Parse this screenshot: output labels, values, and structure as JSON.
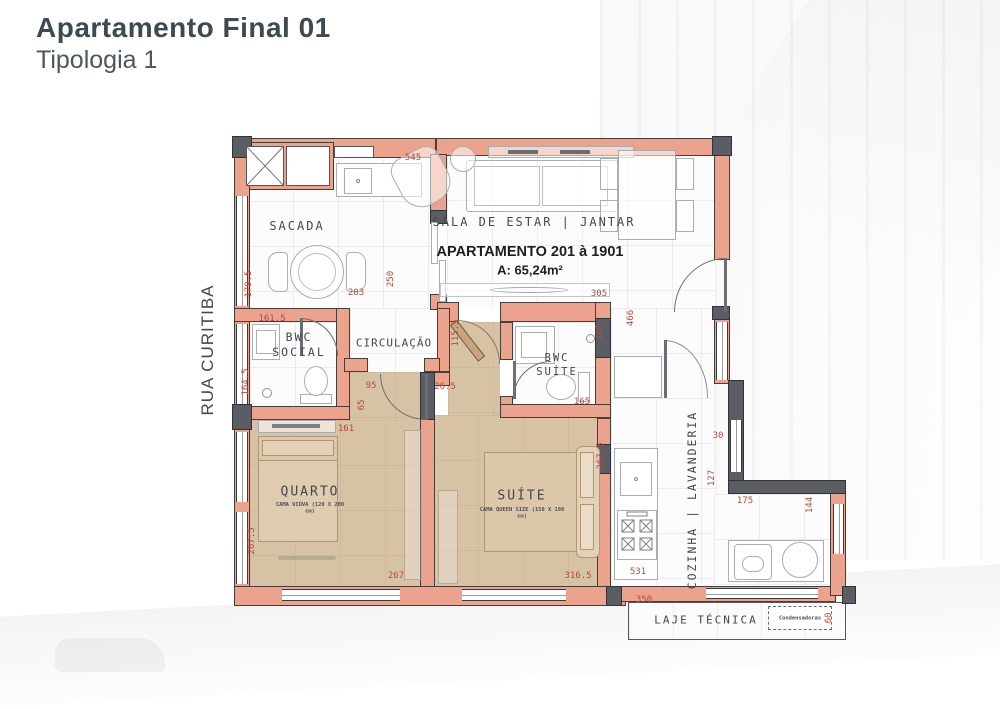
{
  "header": {
    "title": "Apartamento Final 01",
    "subtitle": "Tipologia 1"
  },
  "street_label": "RUA CURITIBA",
  "unit": {
    "name": "APARTAMENTO 201 à 1901",
    "area": "A: 65,24m²"
  },
  "rooms": {
    "sacada": "SACADA",
    "sala": "SALA DE ESTAR | JANTAR",
    "circulacao": "CIRCULAÇÃO",
    "bwc_social_l1": "BWC",
    "bwc_social_l2": "SOCIAL",
    "bwc_suite_l1": "BWC",
    "bwc_suite_l2": "SUÍTE",
    "quarto": "QUARTO",
    "quarto_bed": "CAMA VIÚVA (120 X 200 cm)",
    "suite": "SUÍTE",
    "suite_bed": "CAMA QUEEN SIZE (158 X 198 cm)",
    "cozinha": "COZINHA | LAVANDERIA",
    "laje": "LAJE TÉCNICA",
    "condensadoras": "Condensadoras"
  },
  "colors": {
    "wall": "#EBA38D",
    "structure": "#5A5E64",
    "floor_bedroom": "#D8C2A6",
    "dimension_text": "#B5493C"
  },
  "dimensions": [
    {
      "t": "545",
      "x": 413,
      "y": 158,
      "v": false
    },
    {
      "t": "179.5",
      "x": 249,
      "y": 284,
      "v": true
    },
    {
      "t": "203",
      "x": 356,
      "y": 293,
      "v": false
    },
    {
      "t": "250",
      "x": 391,
      "y": 279,
      "v": true
    },
    {
      "t": "305",
      "x": 599,
      "y": 294,
      "v": false
    },
    {
      "t": "161.5",
      "x": 272,
      "y": 319,
      "v": false
    },
    {
      "t": "164.5",
      "x": 246,
      "y": 382,
      "v": true
    },
    {
      "t": "115.5",
      "x": 456,
      "y": 333,
      "v": true
    },
    {
      "t": "95",
      "x": 371,
      "y": 386,
      "v": false
    },
    {
      "t": "65",
      "x": 362,
      "y": 405,
      "v": true
    },
    {
      "t": "161",
      "x": 346,
      "y": 429,
      "v": false
    },
    {
      "t": "26.5",
      "x": 445,
      "y": 387,
      "v": false
    },
    {
      "t": "165",
      "x": 600,
      "y": 332,
      "v": true
    },
    {
      "t": "466",
      "x": 631,
      "y": 318,
      "v": true
    },
    {
      "t": "165",
      "x": 582,
      "y": 402,
      "v": false
    },
    {
      "t": "30",
      "x": 718,
      "y": 436,
      "v": false
    },
    {
      "t": "127",
      "x": 712,
      "y": 478,
      "v": true
    },
    {
      "t": "175",
      "x": 745,
      "y": 501,
      "v": false
    },
    {
      "t": "144",
      "x": 810,
      "y": 505,
      "v": true
    },
    {
      "t": "267.5",
      "x": 601,
      "y": 456,
      "v": true
    },
    {
      "t": "267.5",
      "x": 252,
      "y": 541,
      "v": true
    },
    {
      "t": "267",
      "x": 396,
      "y": 576,
      "v": false
    },
    {
      "t": "316.5",
      "x": 578,
      "y": 576,
      "v": false
    },
    {
      "t": "531",
      "x": 638,
      "y": 572,
      "v": false
    },
    {
      "t": "350",
      "x": 644,
      "y": 600,
      "v": false
    },
    {
      "t": "60",
      "x": 829,
      "y": 618,
      "v": true
    }
  ]
}
